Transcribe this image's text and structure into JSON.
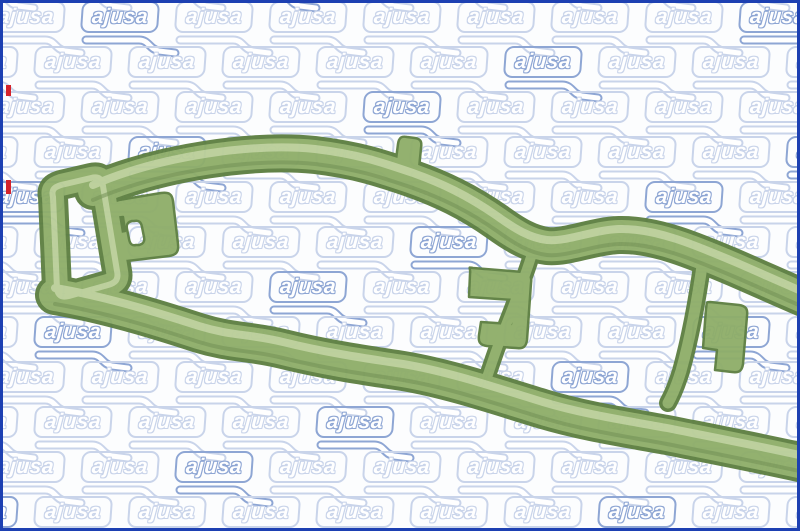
{
  "image": {
    "kind": "product-photo",
    "brand": "ajusa",
    "subject": "green molded rubber gasket seal"
  },
  "watermark": {
    "text": "ajusa"
  },
  "colors": {
    "background": "#fcfdfe",
    "frame_border": "#1d40b2",
    "watermark_light": "#c9d4ea",
    "watermark_dark": "#8ea6d4",
    "accent_red": "#d5232b",
    "gasket_edge": "#5e8042",
    "gasket_mid": "#8fae6a",
    "gasket_highlight": "#c6d8a6",
    "gasket_shadow": "#6f8f50"
  }
}
